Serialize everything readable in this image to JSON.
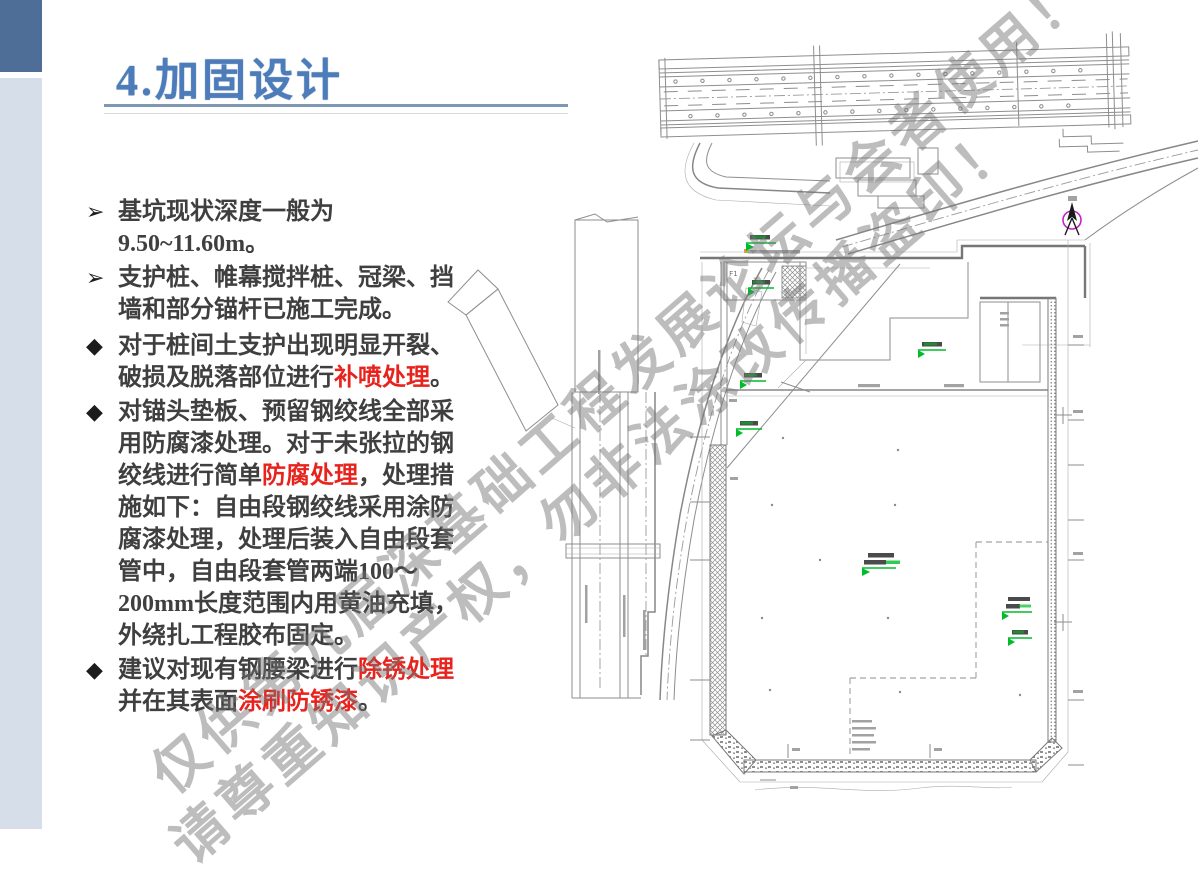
{
  "slide": {
    "title": "4.加固设计",
    "colors": {
      "title_blue": "#4d7cba",
      "accent_bar_dark": "#4e6d97",
      "accent_bar_light": "#d5dee9",
      "body_text": "#3f3f3f",
      "highlight_red": "#e8231d",
      "monitoring_green": "#00bc2a",
      "north_arrow_magenta": "#c026c0",
      "cad_line_gray": "#8e8e8e"
    },
    "icons": {
      "arrow_bullet": "➢",
      "diamond_bullet": "◆"
    },
    "bullets_arrow": [
      {
        "segments": [
          {
            "t": "基坑现状深度一般为9.50~11.60m。"
          }
        ]
      },
      {
        "segments": [
          {
            "t": "支护桩、帷幕搅拌桩、冠梁、挡墙和部分锚杆已施工完成。"
          }
        ]
      }
    ],
    "bullets_diamond": [
      {
        "segments": [
          {
            "t": "对于桩间土支护出现明显开裂、破损及脱落部位进行"
          },
          {
            "t": "补喷处理",
            "red": true
          },
          {
            "t": "。"
          }
        ]
      },
      {
        "segments": [
          {
            "t": "对锚头垫板、预留钢绞线全部采用防腐漆处理。对于未张拉的钢绞线进行简单"
          },
          {
            "t": "防腐处理",
            "red": true
          },
          {
            "t": "，处理措施如下：自由段钢绞线采用涂防腐漆处理，处理后装入自由段套管中，自由段套管两端100～200mm长度范围内用黄油充填，外绕扎工程胶布固定。"
          }
        ]
      },
      {
        "segments": [
          {
            "t": "建议对现有钢腰梁进行"
          },
          {
            "t": "除锈处理",
            "red": true
          },
          {
            "t": "并在其表面"
          },
          {
            "t": "涂刷防锈漆",
            "red": true
          },
          {
            "t": "。"
          }
        ]
      }
    ],
    "watermark": {
      "line1": "仅供第九届深基础工程发展论坛与会者使用！",
      "line2": "请尊重知识产权，勿非法涂改传播盗印！"
    },
    "drawing": {
      "f1_label": "F1"
    }
  }
}
